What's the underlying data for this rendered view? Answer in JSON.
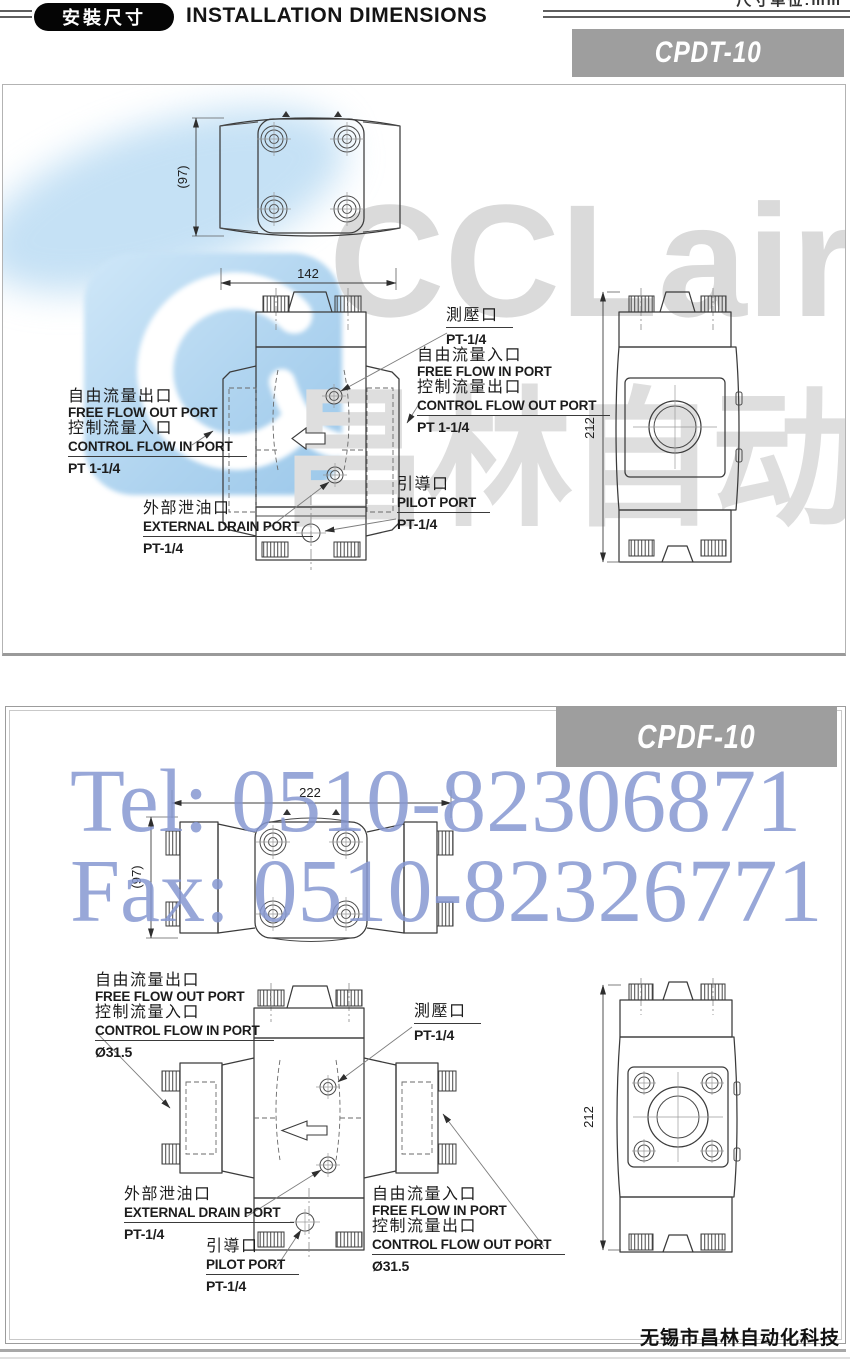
{
  "header": {
    "badge": "安裝尺寸",
    "title": "INSTALLATION DIMENSIONS",
    "corner_fragment": "尺寸单位:mm"
  },
  "sections": [
    {
      "model": "CPDT-10",
      "dims": {
        "top_width": "142",
        "top_height": "(97)",
        "side_height": "212"
      },
      "ann": {
        "out": {
          "cn1": "自由流量出口",
          "en1": "FREE FLOW OUT PORT",
          "cn2": "控制流量入口",
          "en2": "CONTROL FLOW IN PORT",
          "size": "PT 1-1/4"
        },
        "test": {
          "cn": "測壓口",
          "size": "PT-1/4"
        },
        "in": {
          "cn1": "自由流量入口",
          "en1": "FREE FLOW IN PORT",
          "cn2": "控制流量出口",
          "en2": "CONTROL FLOW OUT PORT",
          "size": "PT 1-1/4"
        },
        "drain": {
          "cn": "外部泄油口",
          "en": "EXTERNAL DRAIN PORT",
          "size": "PT-1/4"
        },
        "pilot": {
          "cn": "引導口",
          "en": "PILOT PORT",
          "size": "PT-1/4"
        }
      }
    },
    {
      "model": "CPDF-10",
      "dims": {
        "top_width": "222",
        "top_height": "(97)",
        "side_height": "212"
      },
      "ann": {
        "out": {
          "cn1": "自由流量出口",
          "en1": "FREE FLOW OUT PORT",
          "cn2": "控制流量入口",
          "en2": "CONTROL FLOW IN PORT",
          "size": "Ø31.5"
        },
        "test": {
          "cn": "測壓口",
          "size": "PT-1/4"
        },
        "in": {
          "cn1": "自由流量入口",
          "en1": "FREE FLOW IN PORT",
          "cn2": "控制流量出口",
          "en2": "CONTROL FLOW OUT PORT",
          "size": "Ø31.5"
        },
        "drain": {
          "cn": "外部泄油口",
          "en": "EXTERNAL DRAIN PORT",
          "size": "PT-1/4"
        },
        "pilot": {
          "cn": "引導口",
          "en": "PILOT PORT",
          "size": "PT-1/4"
        }
      }
    }
  ],
  "watermarks": {
    "logo_text": "CCLair",
    "cn_big": "昌林自动化",
    "tel": "Tel: 0510-82306871",
    "fax": "Fax: 0510-82326771"
  },
  "footer": {
    "company": "无锡市昌林自动化科技"
  },
  "colors": {
    "model_tag_bg": "#9e9e9e",
    "badge_bg": "#050505",
    "watermark_blue": "#8698d1",
    "watermark_gray": "#dadada",
    "logo_blue": "#aed3ef"
  }
}
